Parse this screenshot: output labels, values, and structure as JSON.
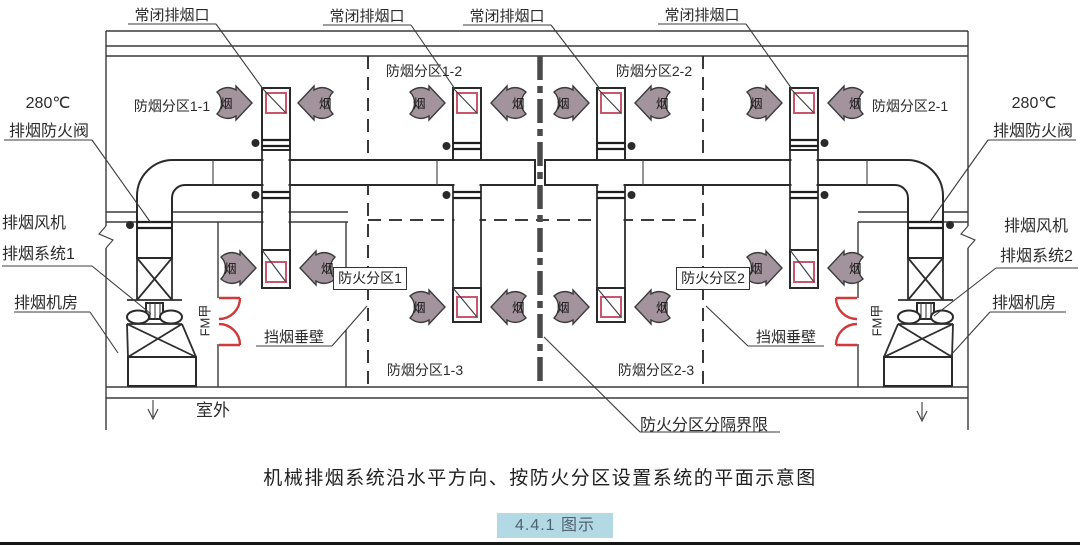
{
  "colors": {
    "accent_red": "#c9566c",
    "door_red": "#d03a3a",
    "arrow_fill": "#a3939c",
    "badge_bg": "#b2d9e4",
    "badge_text": "#4f6470"
  },
  "symbols": {
    "smoke_char": "烟"
  },
  "labels": {
    "normally_closed_vent": "常闭排烟口",
    "damper_temp": "280℃",
    "fire_damper": "排烟防火阀",
    "exhaust_fan": "排烟风机",
    "exhaust_system_1": "排烟系统1",
    "exhaust_system_2": "排烟系统2",
    "fan_room": "排烟机房",
    "smoke_zone_1_1": "防烟分区1-1",
    "smoke_zone_1_2": "防烟分区1-2",
    "smoke_zone_1_3": "防烟分区1-3",
    "smoke_zone_2_1": "防烟分区2-1",
    "smoke_zone_2_2": "防烟分区2-2",
    "smoke_zone_2_3": "防烟分区2-3",
    "fire_zone_1": "防火分区1",
    "fire_zone_2": "防火分区2",
    "smoke_curtain": "挡烟垂壁",
    "fire_zone_boundary": "防火分区分隔界限",
    "fire_door": "FM甲",
    "outdoor": "室外"
  },
  "caption": {
    "title": "机械排烟系统沿水平方向、按防火分区设置系统的平面示意图",
    "figure_badge": "4.4.1 图示"
  }
}
